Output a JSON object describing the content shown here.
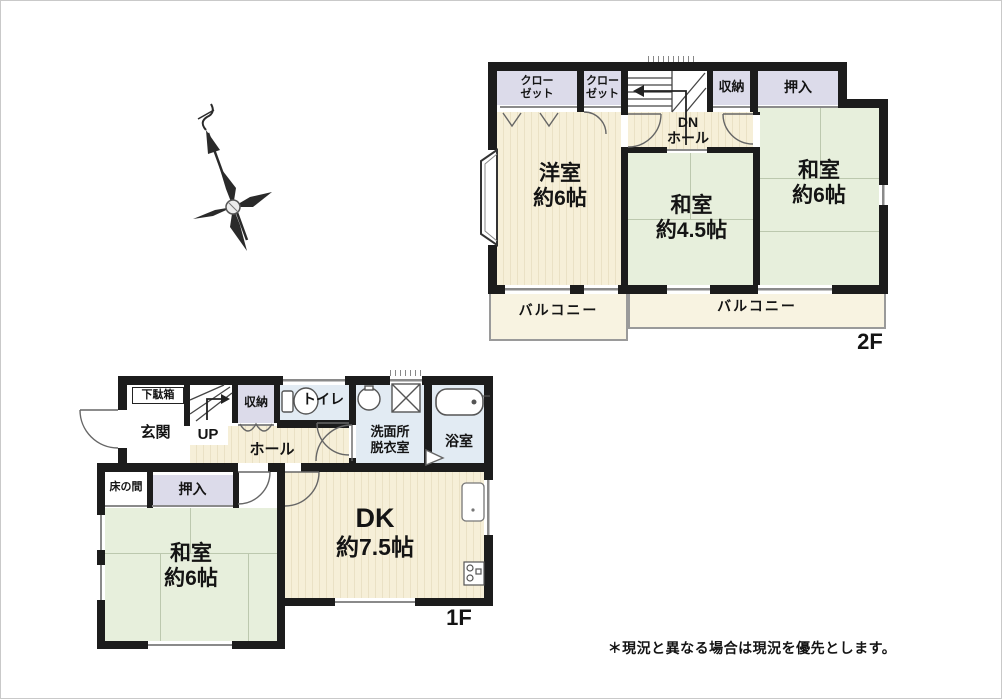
{
  "note": "＊現況と異なる場合は現況を優先とします。",
  "colors": {
    "wall": "#1c1c1c",
    "flooring": "#f6efd8",
    "flooring_stripe": "#eae1c5",
    "tatami": "#e7efdc",
    "storage": "#dcdbea",
    "wet_room": "#e2ebf3",
    "balcony": "#f8f3e1"
  },
  "floor_2f": {
    "floor_label": "2F",
    "closet_left": "クローゼット",
    "closet_right": "クローゼット",
    "storage": "収納",
    "oshiire": "押入",
    "dn_hall_line1": "DN",
    "dn_hall_line2": "ホール",
    "western_room_name": "洋室",
    "western_room_size": "約6帖",
    "tatami_center_name": "和室",
    "tatami_center_size": "約4.5帖",
    "tatami_right_name": "和室",
    "tatami_right_size": "約6帖",
    "balcony_left": "バルコニー",
    "balcony_right": "バルコニー"
  },
  "floor_1f": {
    "floor_label": "1F",
    "shoe_cabinet": "下駄箱",
    "entrance": "玄関",
    "stairs_up": "UP",
    "storage": "収納",
    "toilet": "トイレ",
    "hall": "ホール",
    "washroom_line1": "洗面所",
    "washroom_line2": "脱衣室",
    "bathroom": "浴室",
    "tokonoma": "床の間",
    "oshiire": "押入",
    "tatami_name": "和室",
    "tatami_size": "約6帖",
    "dk_name": "DK",
    "dk_size": "約7.5帖"
  }
}
